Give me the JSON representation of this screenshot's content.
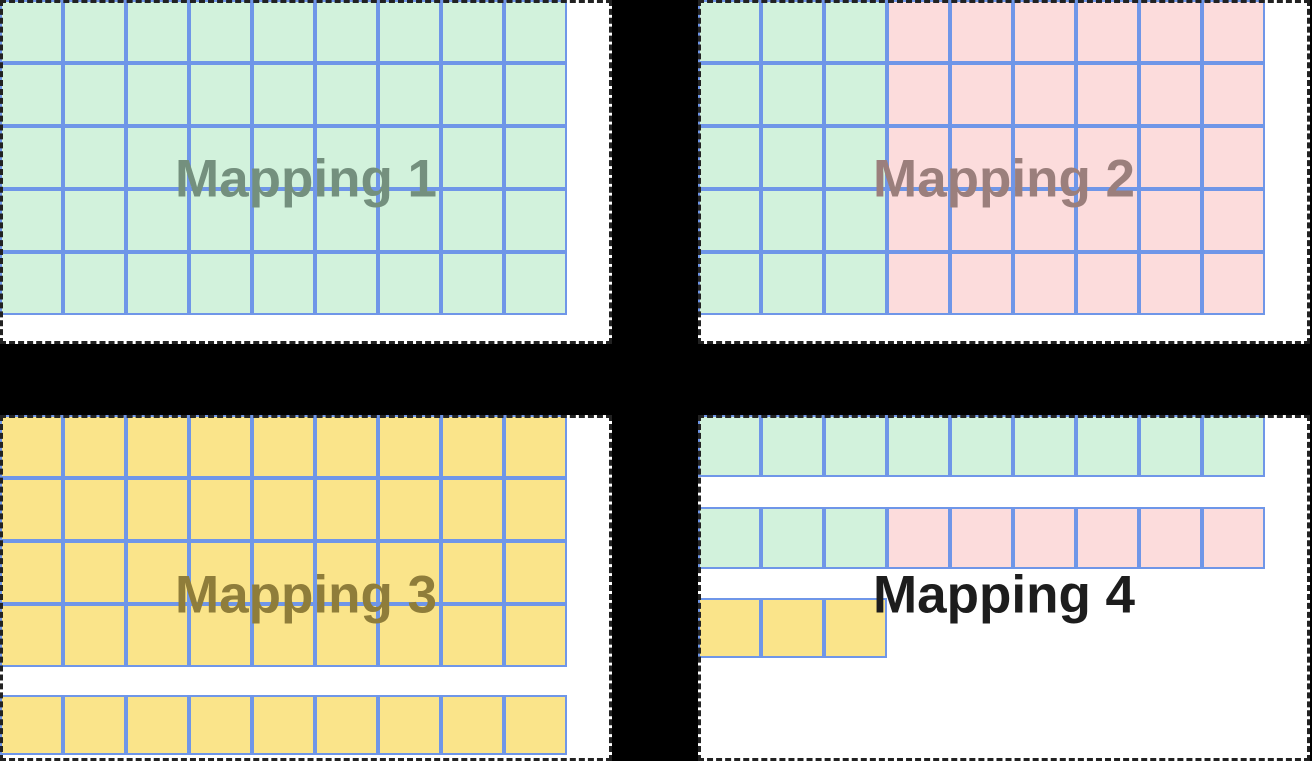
{
  "diagram": {
    "background_color": "#000000",
    "panel_background": "#ffffff",
    "panel_border_color": "#222222",
    "cell_border_color": "#6f96e8",
    "cell_colors": {
      "G": "#d2f2dc",
      "P": "#fcdcdc",
      "Y": "#fae48a"
    },
    "cell_color_legend": {
      "G": "green-cell",
      "P": "pink-cell",
      "Y": "yellow-cell"
    },
    "panels": [
      {
        "id": "mapping-1",
        "label": "Mapping 1",
        "label_color": "#74907e",
        "groups": [
          {
            "cell_h": 63,
            "gap_before": 0,
            "rows": [
              "GGGGGGGGG",
              "GGGGGGGGG",
              "GGGGGGGGG",
              "GGGGGGGGG",
              "GGGGGGGGG"
            ]
          }
        ]
      },
      {
        "id": "mapping-2",
        "label": "Mapping 2",
        "label_color": "#9b7f7c",
        "groups": [
          {
            "cell_h": 63,
            "gap_before": 0,
            "rows": [
              "GGGPPPPPP",
              "GGGPPPPPP",
              "GGGPPPPPP",
              "GGGPPPPPP",
              "GGGPPPPPP"
            ]
          }
        ]
      },
      {
        "id": "mapping-3",
        "label": "Mapping 3",
        "label_color": "#8f7d3a",
        "groups": [
          {
            "cell_h": 63,
            "gap_before": 0,
            "rows": [
              "YYYYYYYYY",
              "YYYYYYYYY",
              "YYYYYYYYY",
              "YYYYYYYYY"
            ]
          },
          {
            "cell_h": 60,
            "gap_before": 28,
            "rows": [
              "YYYYYYYYY"
            ]
          }
        ]
      },
      {
        "id": "mapping-4",
        "label": "Mapping 4",
        "label_color": "#1d1d1d",
        "groups": [
          {
            "cell_h": 62,
            "gap_before": 0,
            "rows": [
              "GGGGGGGGG"
            ]
          },
          {
            "cell_h": 62,
            "gap_before": 30,
            "rows": [
              "GGGPPPPPP"
            ]
          },
          {
            "cell_h": 60,
            "gap_before": 29,
            "rows": [
              "YYY"
            ]
          }
        ]
      }
    ]
  }
}
